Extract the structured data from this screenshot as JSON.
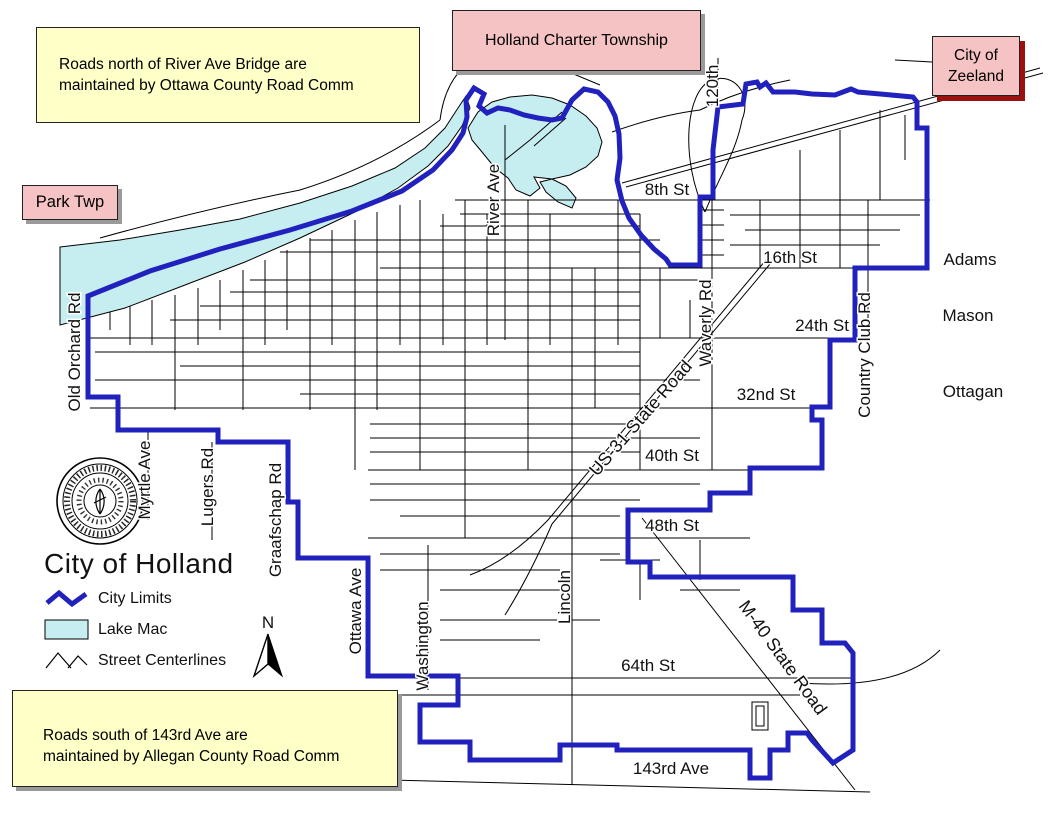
{
  "colors": {
    "city_limits": "#2121BE",
    "lake": "#C6EEF0",
    "street": "#000000",
    "note_bg": "#FFFFC8",
    "township_bg": "#F5C3C3",
    "zeeland_shadow": "#9B1010",
    "gray_shadow": "#9A9A9A"
  },
  "notes": {
    "north": {
      "line1": "Roads north of River Ave Bridge are",
      "line2": "maintained by Ottawa County Road Comm"
    },
    "south": {
      "line1": "Roads south of 143rd Ave are",
      "line2": "maintained by Allegan County Road Comm"
    }
  },
  "areas": {
    "holland_charter_township": "Holland Charter Township",
    "city_of_zeeland_line1": "City of",
    "city_of_zeeland_line2": "Zeeland",
    "park_twp": "Park Twp"
  },
  "legend": {
    "title": "City of Holland",
    "city_limits": "City Limits",
    "lake_mac": "Lake Mac",
    "street_centerlines": "Street Centerlines"
  },
  "north_arrow": {
    "label": "N"
  },
  "roads": {
    "r8th": "8th St",
    "r16th": "16th St",
    "r24th": "24th St",
    "r32nd": "32nd St",
    "r40th": "40th St",
    "r48th": "48th St",
    "r64th": "64th St",
    "r143rd": "143rd Ave",
    "adams": "Adams",
    "mason": "Mason",
    "ottagan": "Ottagan",
    "old_orchard": "Old Orchard Rd",
    "myrtle": "Myrtle Ave",
    "lugers": "Lugers Rd",
    "graafschap": "Graafschap Rd",
    "ottawa": "Ottawa Ave",
    "washington": "Washington",
    "river": "River Ave",
    "lincoln": "Lincoln",
    "waverly": "Waverly Rd",
    "r120th": "120th",
    "country_club": "Country Club Rd",
    "us31": "US-31 State Road",
    "m40": "M-40 State Road"
  }
}
